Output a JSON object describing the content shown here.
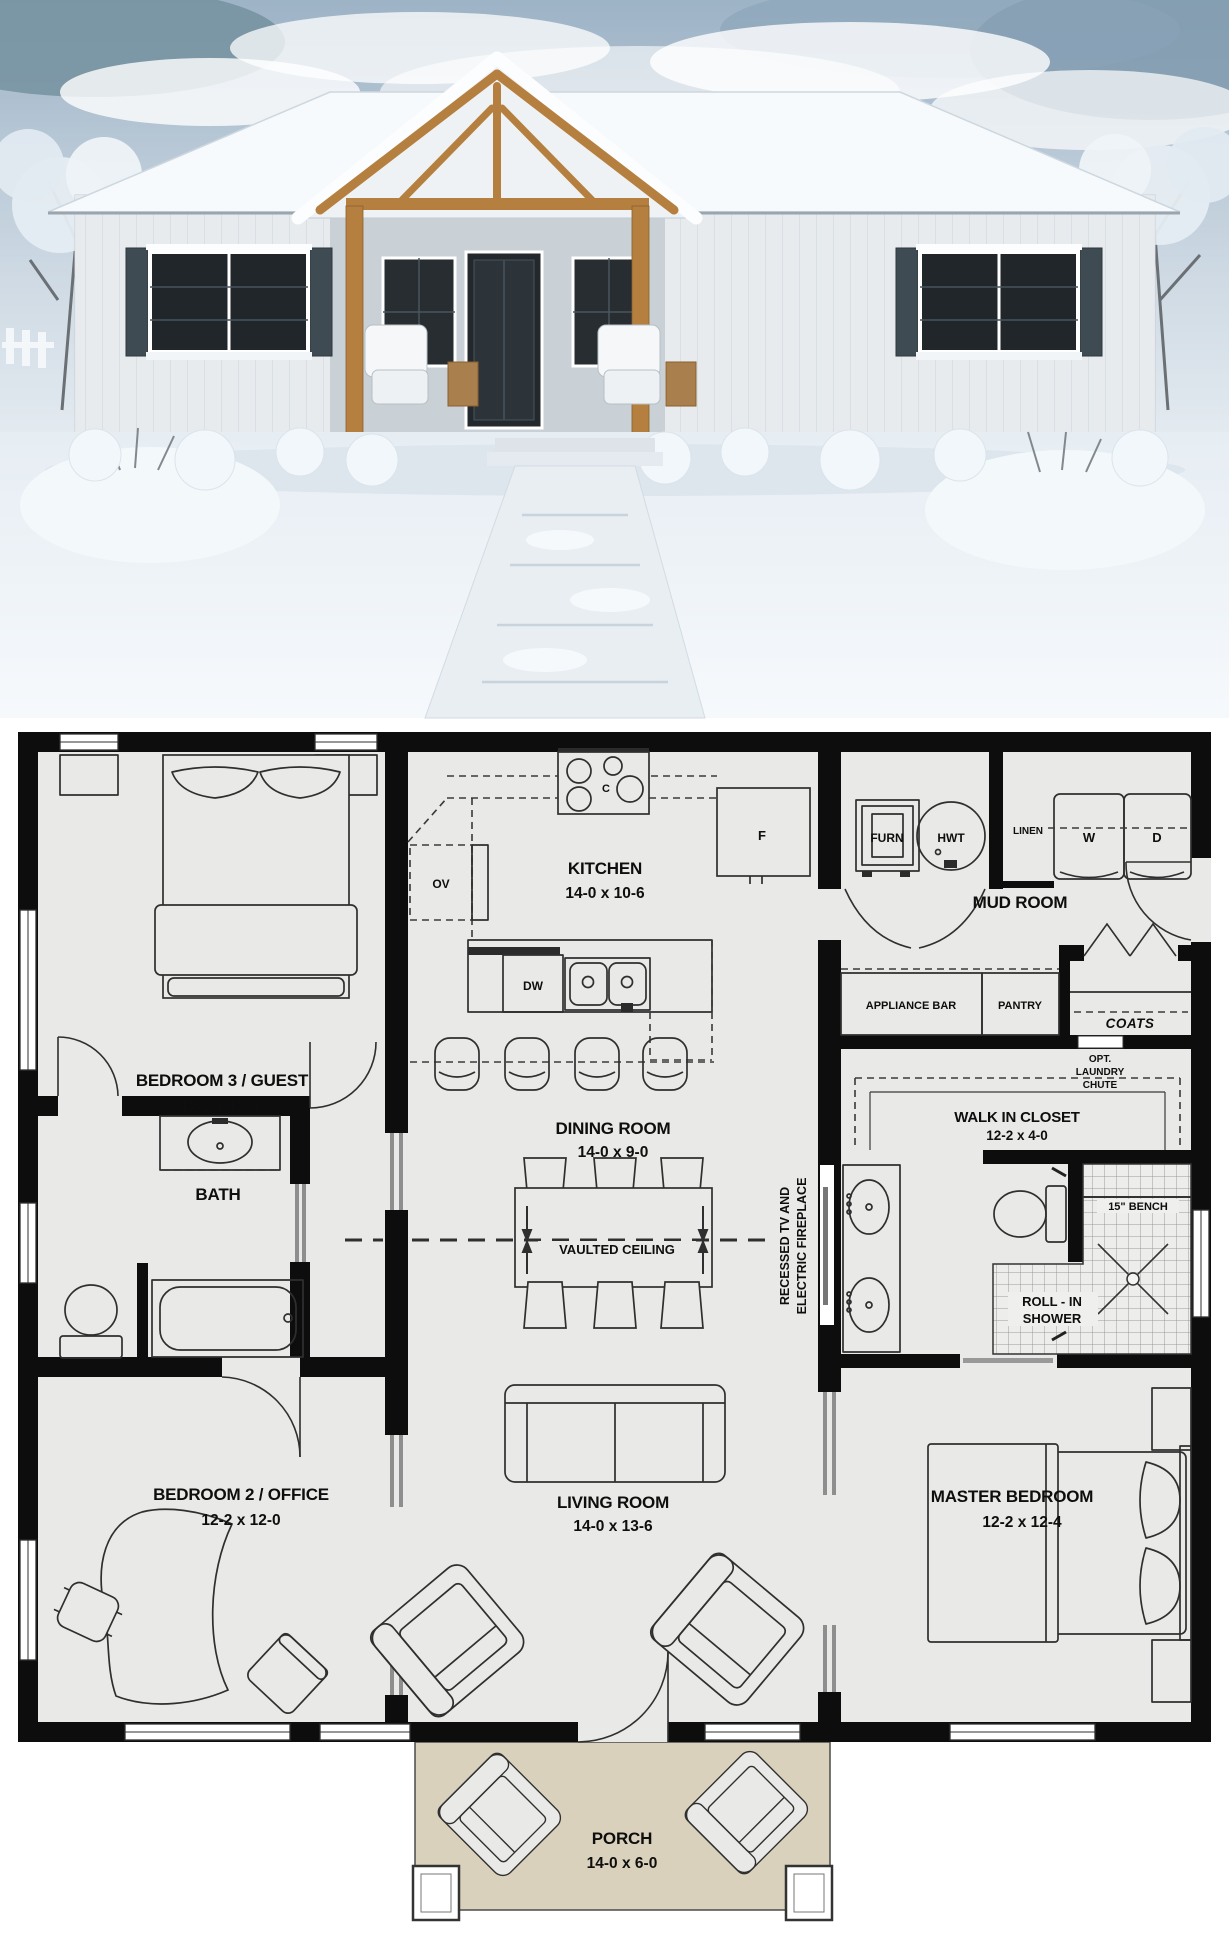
{
  "plan": {
    "rooms": {
      "bedroom3": {
        "name": "BEDROOM 3 / GUEST",
        "dims": "12-2 x 12-0"
      },
      "bath": {
        "name": "BATH"
      },
      "bedroom2": {
        "name": "BEDROOM 2 / OFFICE",
        "dims": "12-2 x 12-0"
      },
      "kitchen": {
        "name": "KITCHEN",
        "dims": "14-0 x 10-6"
      },
      "dining": {
        "name": "DINING ROOM",
        "dims": "14-0 x 9-0"
      },
      "living": {
        "name": "LIVING ROOM",
        "dims": "14-0 x 13-6"
      },
      "mudroom": {
        "name": "MUD ROOM"
      },
      "walkin_closet": {
        "name": "WALK IN CLOSET",
        "dims": "12-2 x 4-0"
      },
      "master": {
        "name": "MASTER BEDROOM",
        "dims": "12-2 x 12-4"
      },
      "porch": {
        "name": "PORCH",
        "dims": "14-0 x 6-0"
      }
    },
    "fixtures": {
      "fridge": "F",
      "oven": "OV",
      "dishwasher": "DW",
      "cooktop": "C",
      "furnace": "FURN",
      "water_heater": "HWT",
      "linen": "LINEN",
      "washer": "W",
      "dryer": "D",
      "appliance_bar": "APPLIANCE BAR",
      "pantry": "PANTRY",
      "coats": "COATS"
    },
    "notes": {
      "vaulted": "VAULTED CEILING",
      "tv_line1": "RECESSED TV AND",
      "tv_line2": "ELECTRIC FIREPLACE",
      "chute_line1": "OPT.",
      "chute_line2": "LAUNDRY",
      "chute_line3": "CHUTE",
      "bench": "15\" BENCH",
      "shower_line1": "ROLL - IN",
      "shower_line2": "SHOWER"
    },
    "colors": {
      "wall": "#0d0d0d",
      "floor": "#e9e9e7",
      "porch": "#d9d1bb",
      "tile_line": "#9a9a98"
    }
  }
}
